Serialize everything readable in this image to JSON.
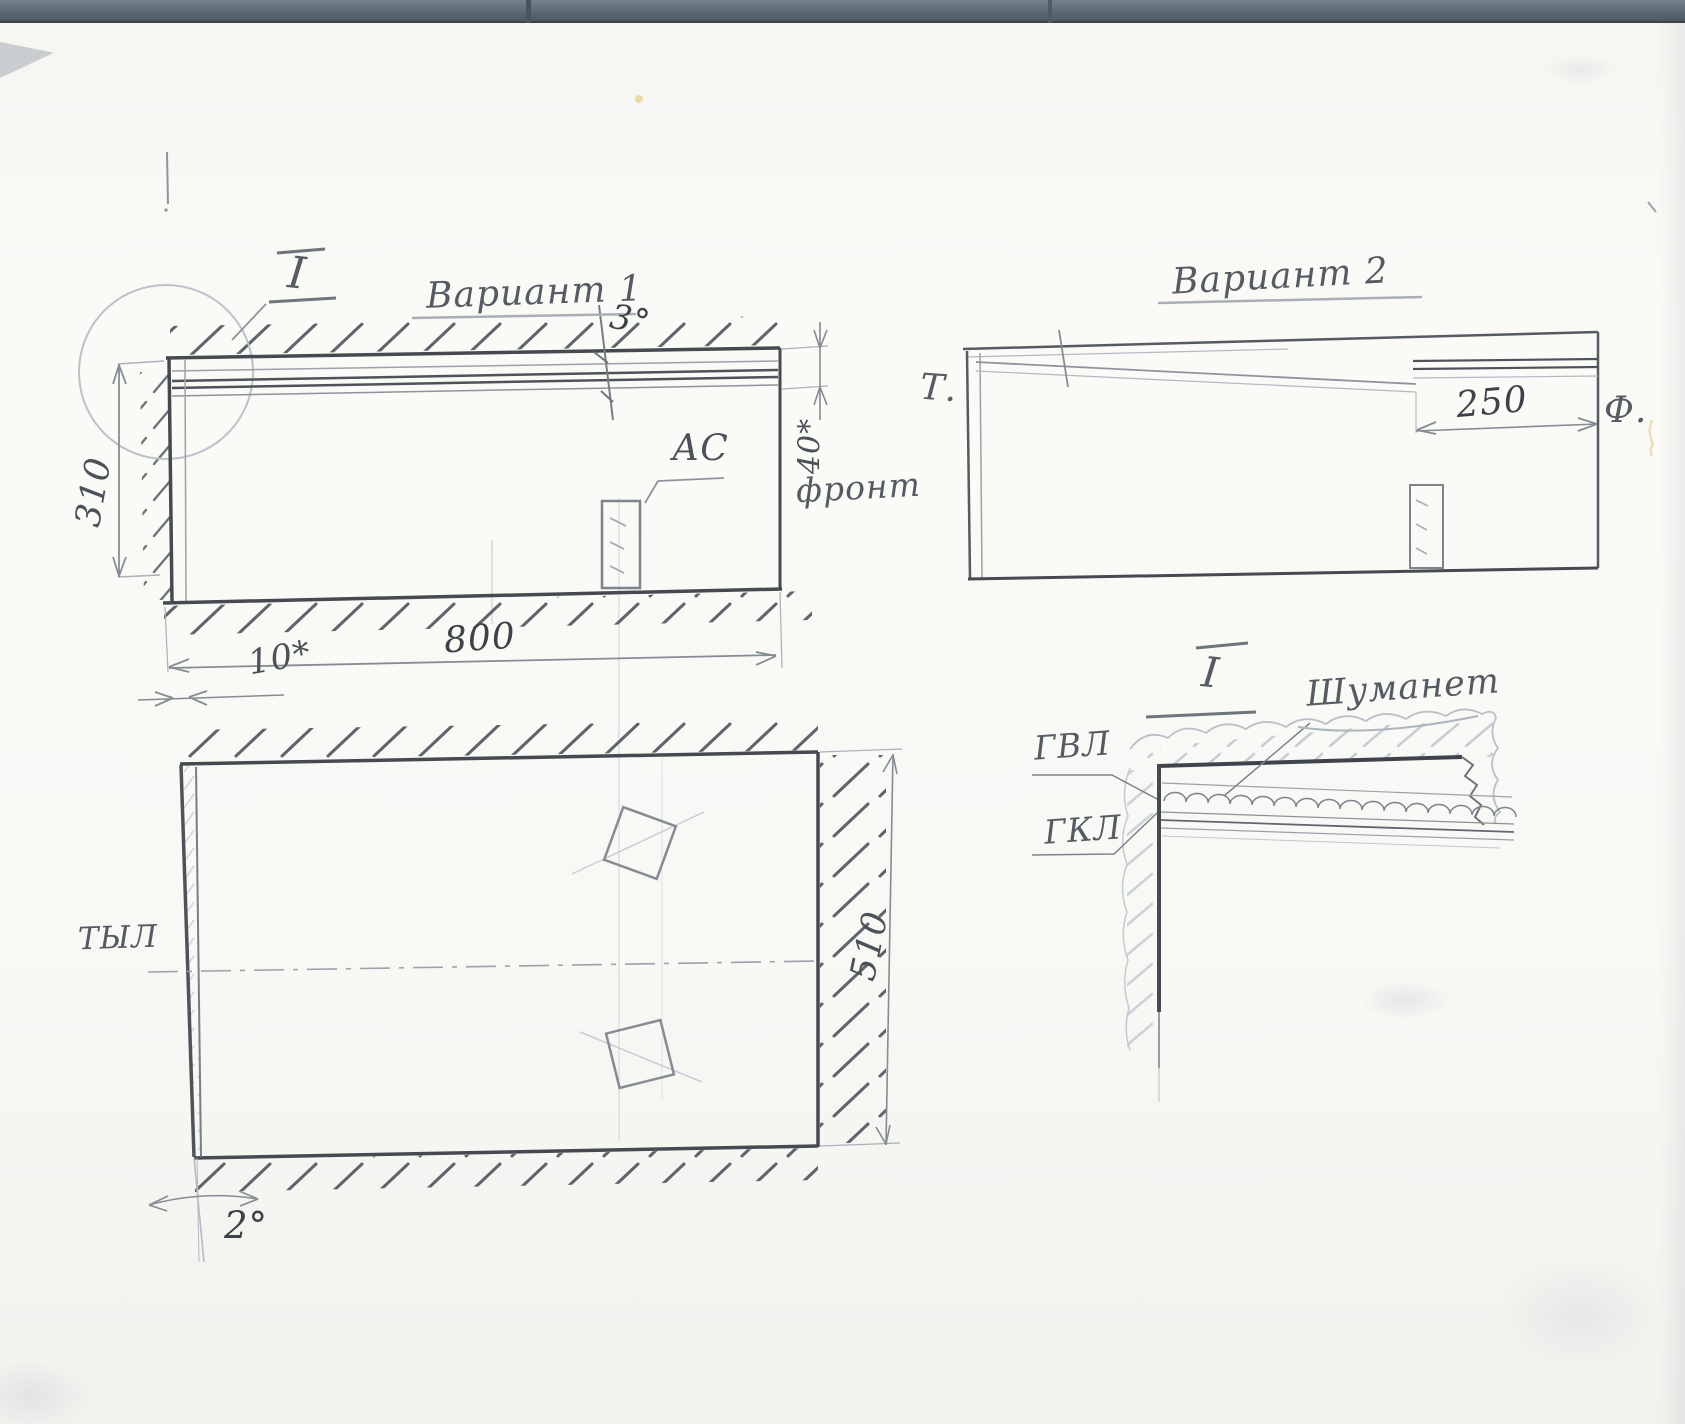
{
  "variant1": {
    "title": "Вариант 1",
    "detail_marker": "I",
    "height_dim": "310",
    "width_dim": "800",
    "gap_dim": "10*",
    "drop_dim": "40*",
    "slope_angle": "3°",
    "speaker_label": "АС",
    "front_label": "фронт"
  },
  "variant2": {
    "title": "Вариант 2",
    "rear_label": "Т.",
    "front_label": "Ф.",
    "front_dim": "250"
  },
  "plan": {
    "rear_label": "ТЫЛ",
    "depth_dim": "510",
    "tilt_angle": "2°"
  },
  "detail": {
    "marker": "I",
    "insulation_label": "Шуманет",
    "gvl_label": "ГВЛ",
    "gkl_label": "ГКЛ"
  },
  "colors": {
    "paper": "#f8f8f5",
    "pencil_dark": "#454a50",
    "pencil_light": "#aab1b8",
    "scanner_strip": "#5e6b74"
  }
}
